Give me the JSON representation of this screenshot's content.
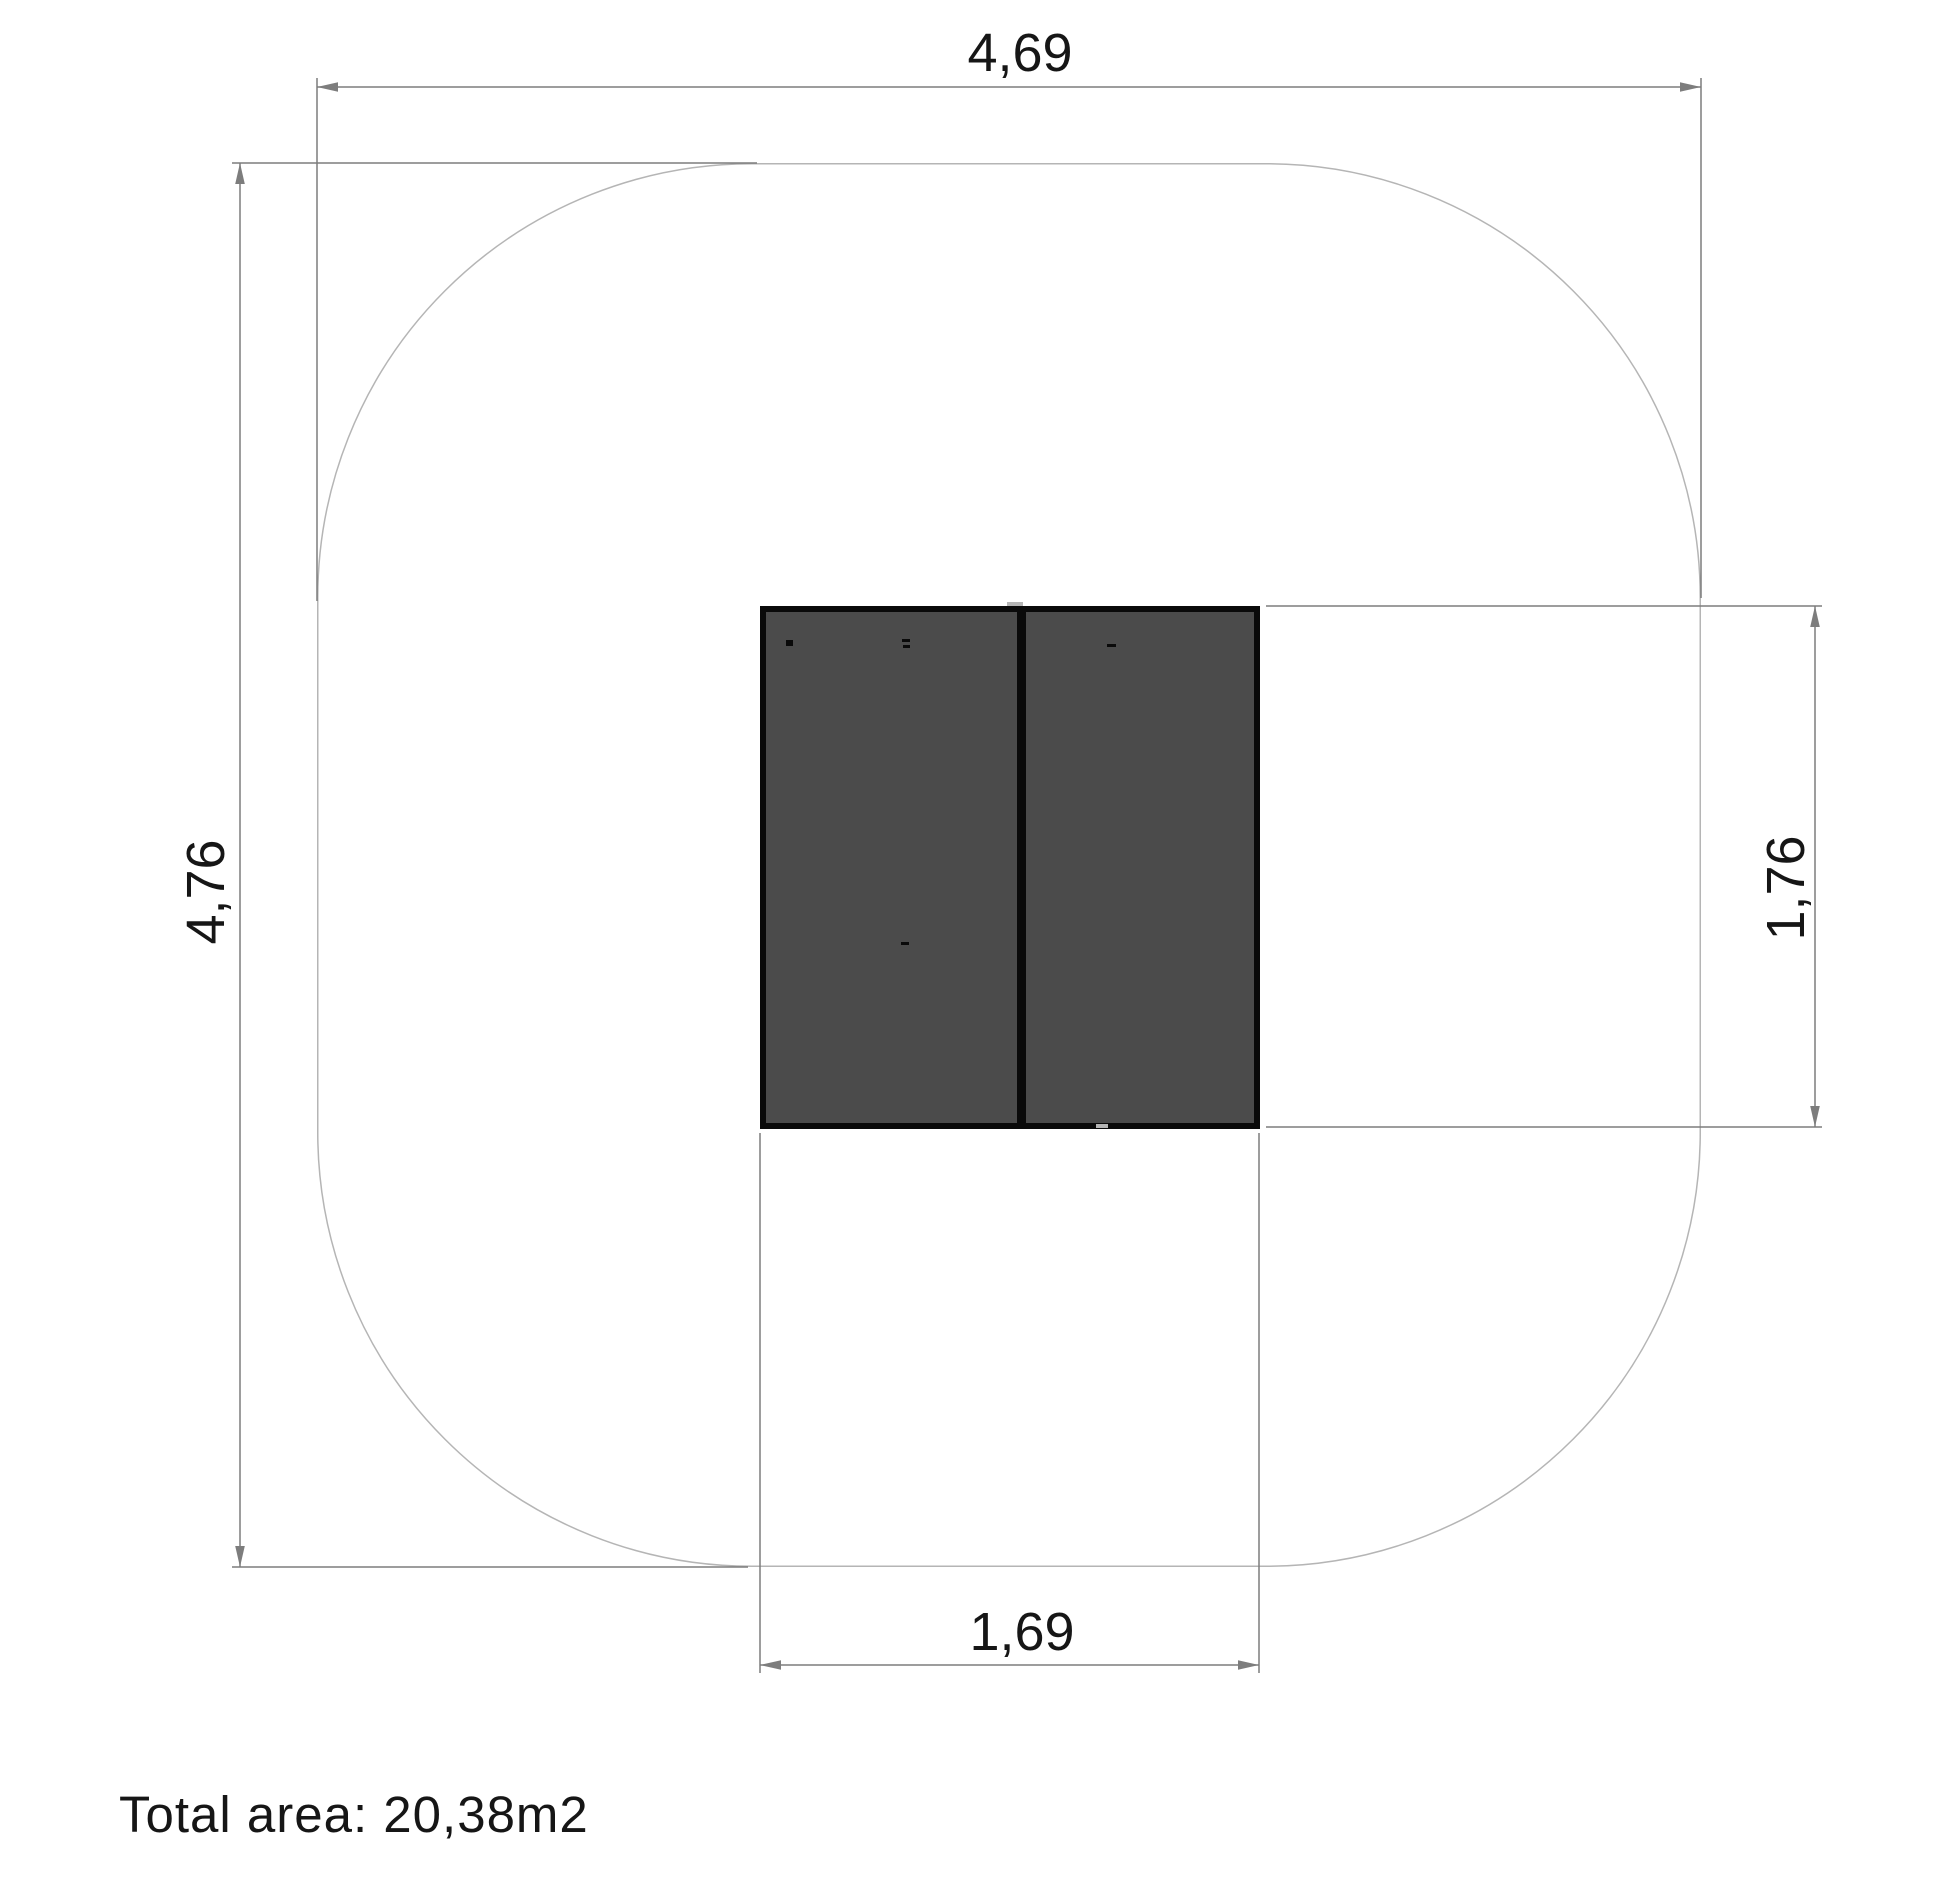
{
  "drawing": {
    "view": "top-view-plan-with-safety-zone",
    "dimensions": {
      "overall_width": "4,69",
      "overall_height": "4,76",
      "unit_height": "1,76",
      "unit_width": "1,69"
    },
    "total_area": "Total area: 20,38m2",
    "colors": {
      "dimension_line": "#7d7d7d",
      "zone_outline": "#b5b5b5",
      "equipment_fill": "#4b4b4b",
      "equipment_border": "#0a0a0a",
      "label_text": "#161616",
      "background": "#ffffff"
    }
  }
}
